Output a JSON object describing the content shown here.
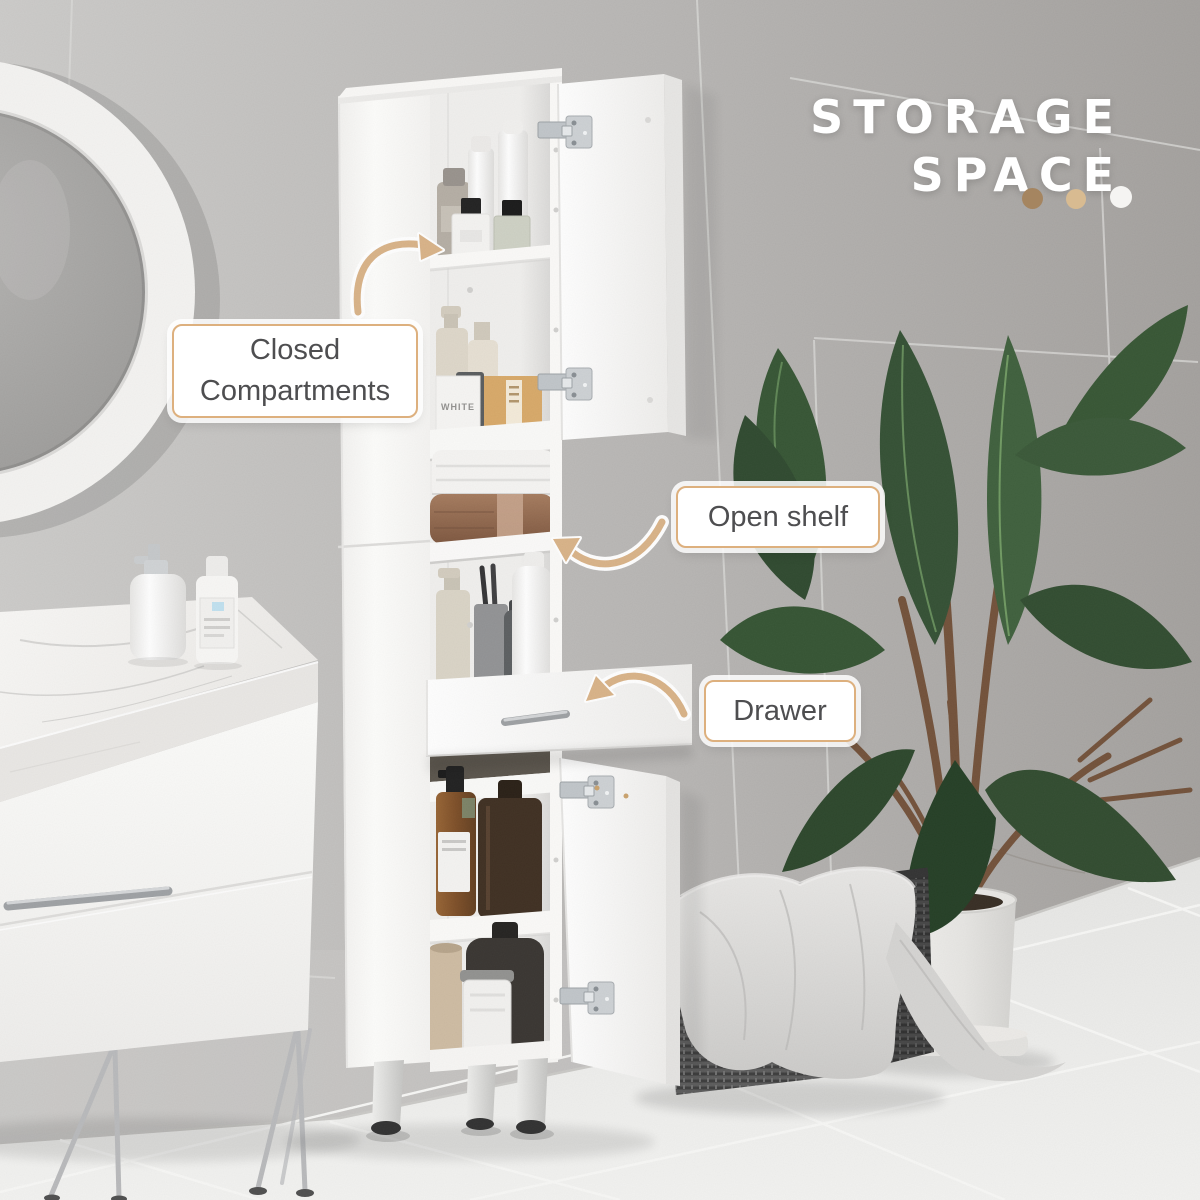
{
  "title": {
    "line1": "STORAGE",
    "line2": "SPACE"
  },
  "annotations": {
    "closed_compartments": {
      "line1": "Closed",
      "line2": "Compartments"
    },
    "open_shelf": {
      "label": "Open shelf"
    },
    "drawer": {
      "label": "Drawer"
    }
  },
  "product_text": {
    "box_label": "WHITE",
    "toothpaste_label": "MARVIS"
  },
  "colors": {
    "accent_tan": "#D8B185",
    "label_border": "#DDB07E",
    "label_text": "#4E4E50",
    "title_text": "#FFFFFF",
    "dot_brown": "#A58560",
    "dot_tan": "#D8BB91",
    "dot_white": "#F5F4F2"
  }
}
